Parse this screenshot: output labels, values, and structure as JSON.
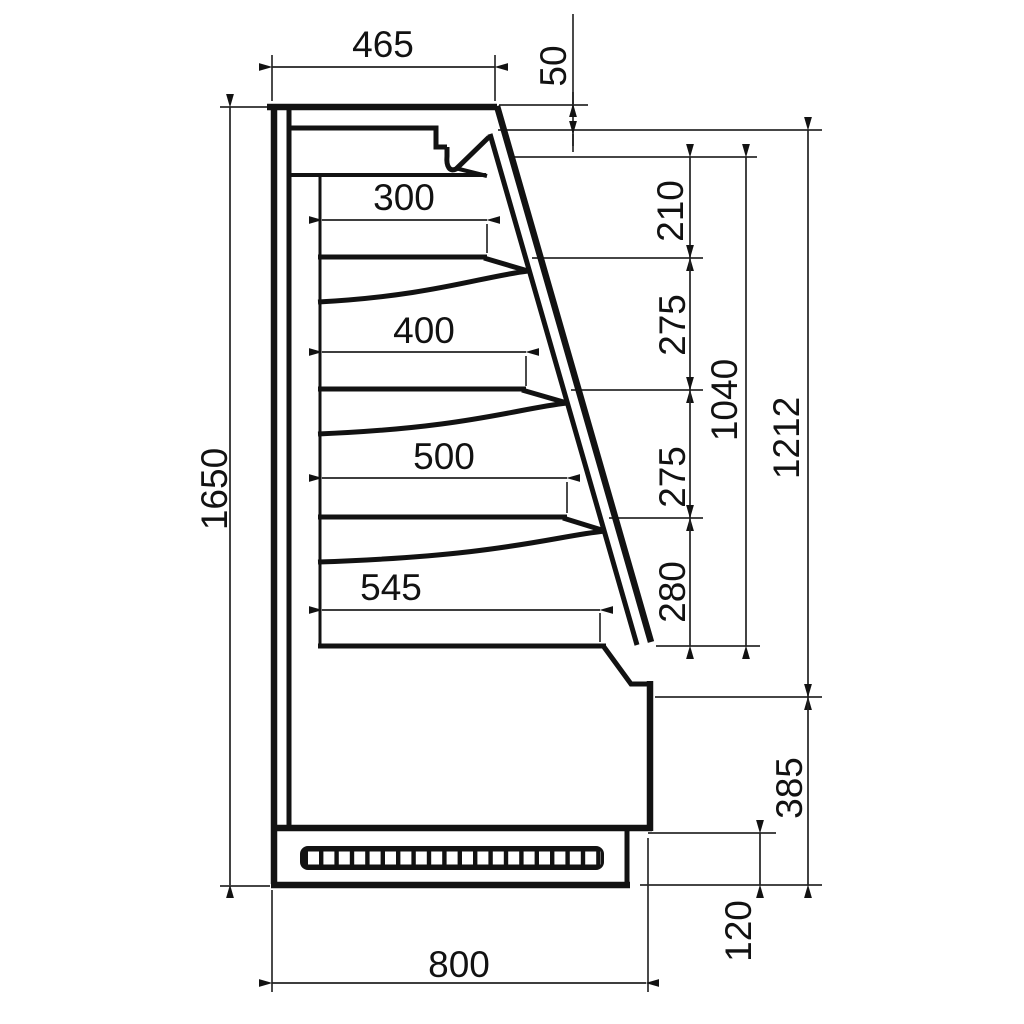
{
  "drawing": {
    "type": "technical-side-section",
    "subject": "refrigerated wall display cabinet side profile with four shelves",
    "units": "mm",
    "line_color": "#121212",
    "background_color": "#ffffff",
    "dims": {
      "top_depth": "465",
      "canopy_lip_height": "50",
      "shelf1_depth": "300",
      "shelf2_depth": "400",
      "shelf3_depth": "500",
      "base_shelf_depth": "545",
      "spacing_canopy_to_shelf1": "210",
      "spacing_shelf1_to_shelf2": "275",
      "spacing_shelf2_to_shelf3": "275",
      "spacing_shelf3_to_base": "280",
      "display_opening_height": "1040",
      "front_glass_height": "1212",
      "total_height": "1650",
      "lower_front_height": "385",
      "plinth_height": "120",
      "total_depth": "800"
    }
  }
}
